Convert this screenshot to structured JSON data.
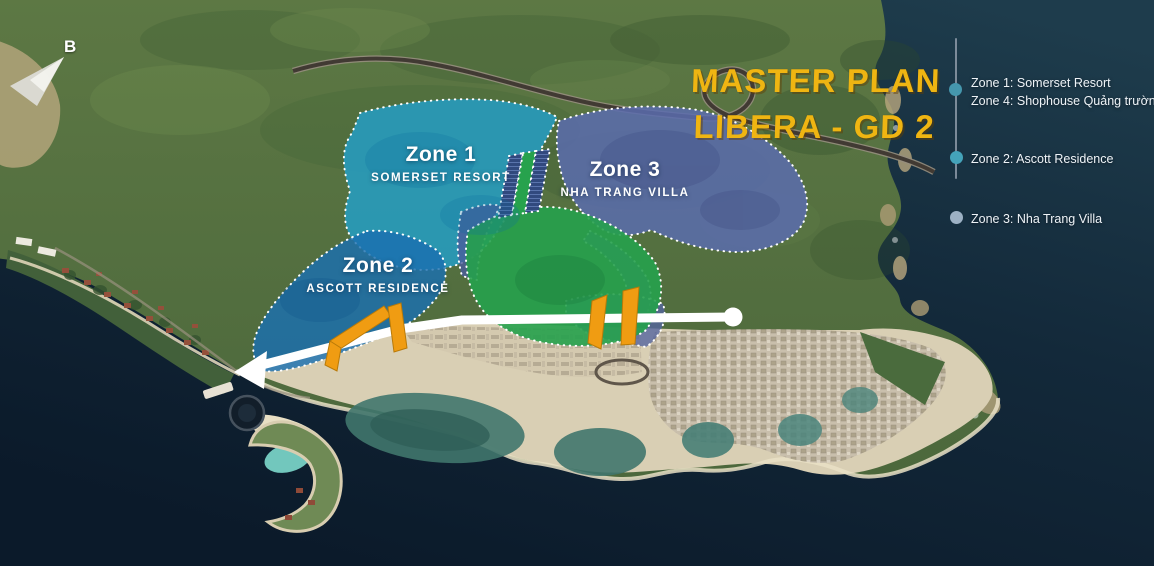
{
  "title": {
    "line1": "MASTER PLAN",
    "line2": "LIBERA - GD 2"
  },
  "compass": {
    "label": "B"
  },
  "zones": [
    {
      "id": "zone1",
      "name": "Zone 1",
      "subtitle": "SOMERSET RESORT",
      "fill": "#249EC4"
    },
    {
      "id": "zone2",
      "name": "Zone 2",
      "subtitle": "ASCOTT RESIDENCE",
      "fill": "#1B6FB0"
    },
    {
      "id": "zone3",
      "name": "Zone 3",
      "subtitle": "NHA TRANG VILLA",
      "fill": "#5A6CAE"
    }
  ],
  "legend": {
    "items": [
      {
        "lines": [
          "Zone 1: Somerset Resort",
          "Zone 4: Shophouse Quảng trường"
        ],
        "dot_color": "#4597AD"
      },
      {
        "lines": [
          "Zone 2: Ascott Residence"
        ],
        "dot_color": "#44A3BA"
      },
      {
        "lines": [
          "Zone 3: Nha Trang Villa"
        ],
        "dot_color": "#9DB1C4"
      }
    ]
  },
  "colors": {
    "title_gold": "#EFB512",
    "zone1_fill": "#249EC4",
    "zone2_fill": "#1B6FB0",
    "zone3_fill": "#5A6CAE",
    "green_area": "#26A14C",
    "gate_orange": "#F09C12",
    "road_white": "#FFFFFF",
    "sea_dark": "#0B1A2A"
  }
}
